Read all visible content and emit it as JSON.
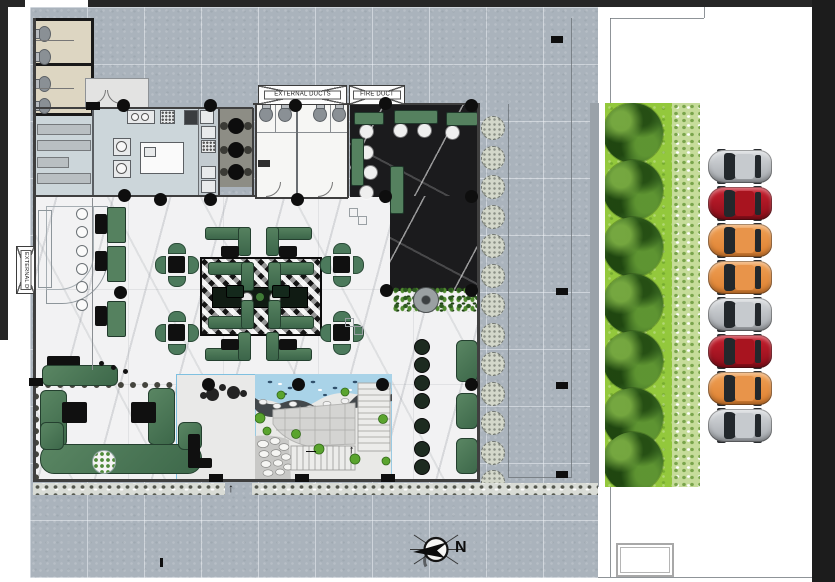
{
  "labels": {
    "external_ducts_top": "EXTERNAL DUCTS",
    "fire_duct": "FIRE DUCT",
    "external_ducts_side": "EXTERNAL DUCTS",
    "north": "N",
    "entrance_arrow": "↑",
    "stair_up_arrow": "↑",
    "stair_dash": "—"
  },
  "palette": {
    "plaza": "#aab3bc",
    "lawn": "#93c83c",
    "marble_white": "#f2f2f3",
    "marble_dark": "#1b1b1d",
    "kitchen_floor": "#ccd6da",
    "toilet_floor": "#ddd6c2",
    "booth_green": "#4c7a5c",
    "water": "#a9d3e8",
    "car_silver": "#b9bcc0",
    "car_red": "#a9121f",
    "car_orange": "#e8933f",
    "frame_dark": "#262626"
  },
  "parking": {
    "cars": [
      {
        "color_name": "silver"
      },
      {
        "color_name": "red"
      },
      {
        "color_name": "orange"
      },
      {
        "color_name": "orange"
      },
      {
        "color_name": "silver"
      },
      {
        "color_name": "red"
      },
      {
        "color_name": "orange"
      },
      {
        "color_name": "silver"
      }
    ],
    "car_y": [
      150,
      187,
      224,
      261,
      298,
      335,
      372,
      409
    ]
  },
  "landscape": {
    "tree_count": 7,
    "tree_y": [
      133,
      190,
      247,
      304,
      361,
      418,
      462
    ],
    "planter_count": 13
  },
  "plan": {
    "column_dots": [
      [
        123,
        105
      ],
      [
        210,
        105
      ],
      [
        295,
        105
      ],
      [
        385,
        103
      ],
      [
        471,
        105
      ],
      [
        160,
        199
      ],
      [
        210,
        199
      ],
      [
        297,
        199
      ],
      [
        385,
        196
      ],
      [
        471,
        196
      ],
      [
        124,
        195
      ],
      [
        120,
        292
      ],
      [
        386,
        290
      ],
      [
        471,
        290
      ],
      [
        208,
        384
      ],
      [
        298,
        384
      ],
      [
        382,
        384
      ],
      [
        471,
        384
      ]
    ],
    "wall_ticks": [
      [
        209,
        474
      ],
      [
        295,
        474
      ],
      [
        381,
        474
      ],
      [
        29,
        378
      ],
      [
        86,
        102
      ]
    ],
    "plaza_markers": [
      [
        551,
        36
      ],
      [
        556,
        288
      ],
      [
        556,
        382
      ],
      [
        556,
        471
      ]
    ],
    "booths": [
      {
        "x": 205,
        "y": 227,
        "t": "tl"
      },
      {
        "x": 266,
        "y": 227,
        "t": "tr"
      },
      {
        "x": 208,
        "y": 262,
        "t": "tl"
      },
      {
        "x": 268,
        "y": 262,
        "t": "tr"
      },
      {
        "x": 208,
        "y": 300,
        "t": "bl"
      },
      {
        "x": 268,
        "y": 300,
        "t": "br"
      },
      {
        "x": 205,
        "y": 332,
        "t": "bl"
      },
      {
        "x": 266,
        "y": 332,
        "t": "br"
      }
    ],
    "booth_tables": [
      [
        221,
        246
      ],
      [
        279,
        246
      ],
      [
        221,
        339
      ],
      [
        279,
        339
      ]
    ],
    "band_tables": [
      [
        226,
        285
      ],
      [
        272,
        285
      ]
    ],
    "dining_sets": [
      [
        176,
        264
      ],
      [
        176,
        332
      ],
      [
        341,
        264
      ],
      [
        341,
        332
      ]
    ],
    "wall_booths": [
      [
        107,
        207
      ],
      [
        107,
        246
      ],
      [
        107,
        301
      ]
    ],
    "wall_booth_tables": [
      [
        95,
        214
      ],
      [
        95,
        251
      ],
      [
        95,
        306
      ]
    ],
    "bar_stool_ys": [
      208,
      226,
      245,
      263,
      281,
      299
    ],
    "toilets_left": [
      [
        38,
        26
      ],
      [
        38,
        49
      ],
      [
        38,
        76
      ],
      [
        38,
        98
      ]
    ],
    "toilets_top": [
      [
        259,
        107
      ],
      [
        278,
        107
      ],
      [
        313,
        107
      ],
      [
        332,
        107
      ]
    ],
    "cafe_tables": [
      [
        236,
        126
      ],
      [
        236,
        150
      ],
      [
        236,
        172
      ]
    ],
    "lounge_white_tables": [
      [
        366,
        131
      ],
      [
        400,
        130
      ],
      [
        424,
        130
      ],
      [
        452,
        132
      ],
      [
        366,
        152
      ],
      [
        370,
        172
      ],
      [
        366,
        192
      ]
    ],
    "lounge_benches": [
      {
        "x": 354,
        "y": 112,
        "w": 28,
        "h": 11
      },
      {
        "x": 394,
        "y": 110,
        "w": 42,
        "h": 12
      },
      {
        "x": 446,
        "y": 112,
        "w": 30,
        "h": 12
      },
      {
        "x": 351,
        "y": 138,
        "w": 11,
        "h": 46
      },
      {
        "x": 390,
        "y": 166,
        "w": 12,
        "h": 46
      }
    ],
    "corridor_sofas": [
      {
        "x": 456,
        "y": 340,
        "h": 40
      },
      {
        "x": 456,
        "y": 393,
        "h": 34
      },
      {
        "x": 456,
        "y": 438,
        "h": 34
      }
    ],
    "corridor_table_ys": [
      346,
      364,
      382,
      400,
      425,
      448,
      466
    ],
    "decor_squares": [
      [
        349,
        208
      ],
      [
        358,
        216
      ],
      [
        345,
        318
      ],
      [
        354,
        326
      ]
    ]
  }
}
